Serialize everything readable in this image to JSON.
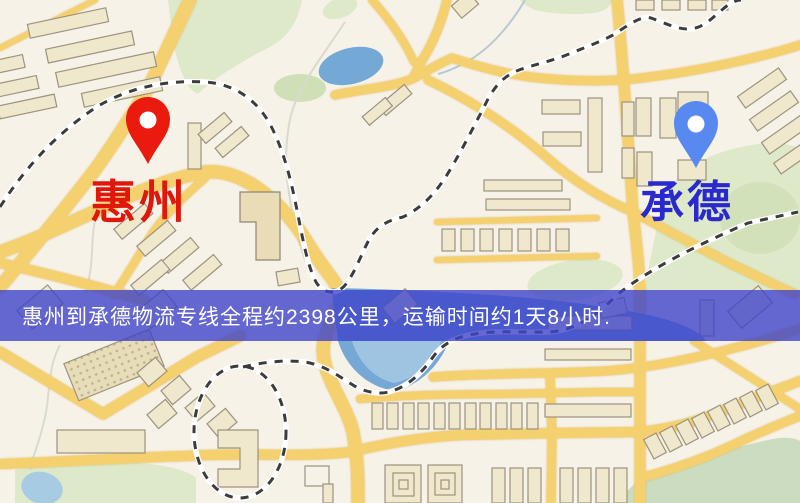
{
  "banner": {
    "text": "惠州到承德物流专线全程约2398公里，运输时间约1天8小时.",
    "background_color": "#3f44c9",
    "text_color": "#ffffff"
  },
  "markers": {
    "origin": {
      "label": "惠州",
      "pin_color": "#ea1b0e",
      "label_color": "#e0170b"
    },
    "destination": {
      "label": "承德",
      "pin_color": "#5789f0",
      "label_color": "#2929ce"
    }
  },
  "map_colors": {
    "background": "#f7f2e8",
    "road": "#f5d06f",
    "building_fill": "#f0e8cd",
    "building_stroke": "#9c937e",
    "park": "#dde9c9",
    "water": "#74a9d6",
    "railway_dash": "#3c3c3c"
  }
}
